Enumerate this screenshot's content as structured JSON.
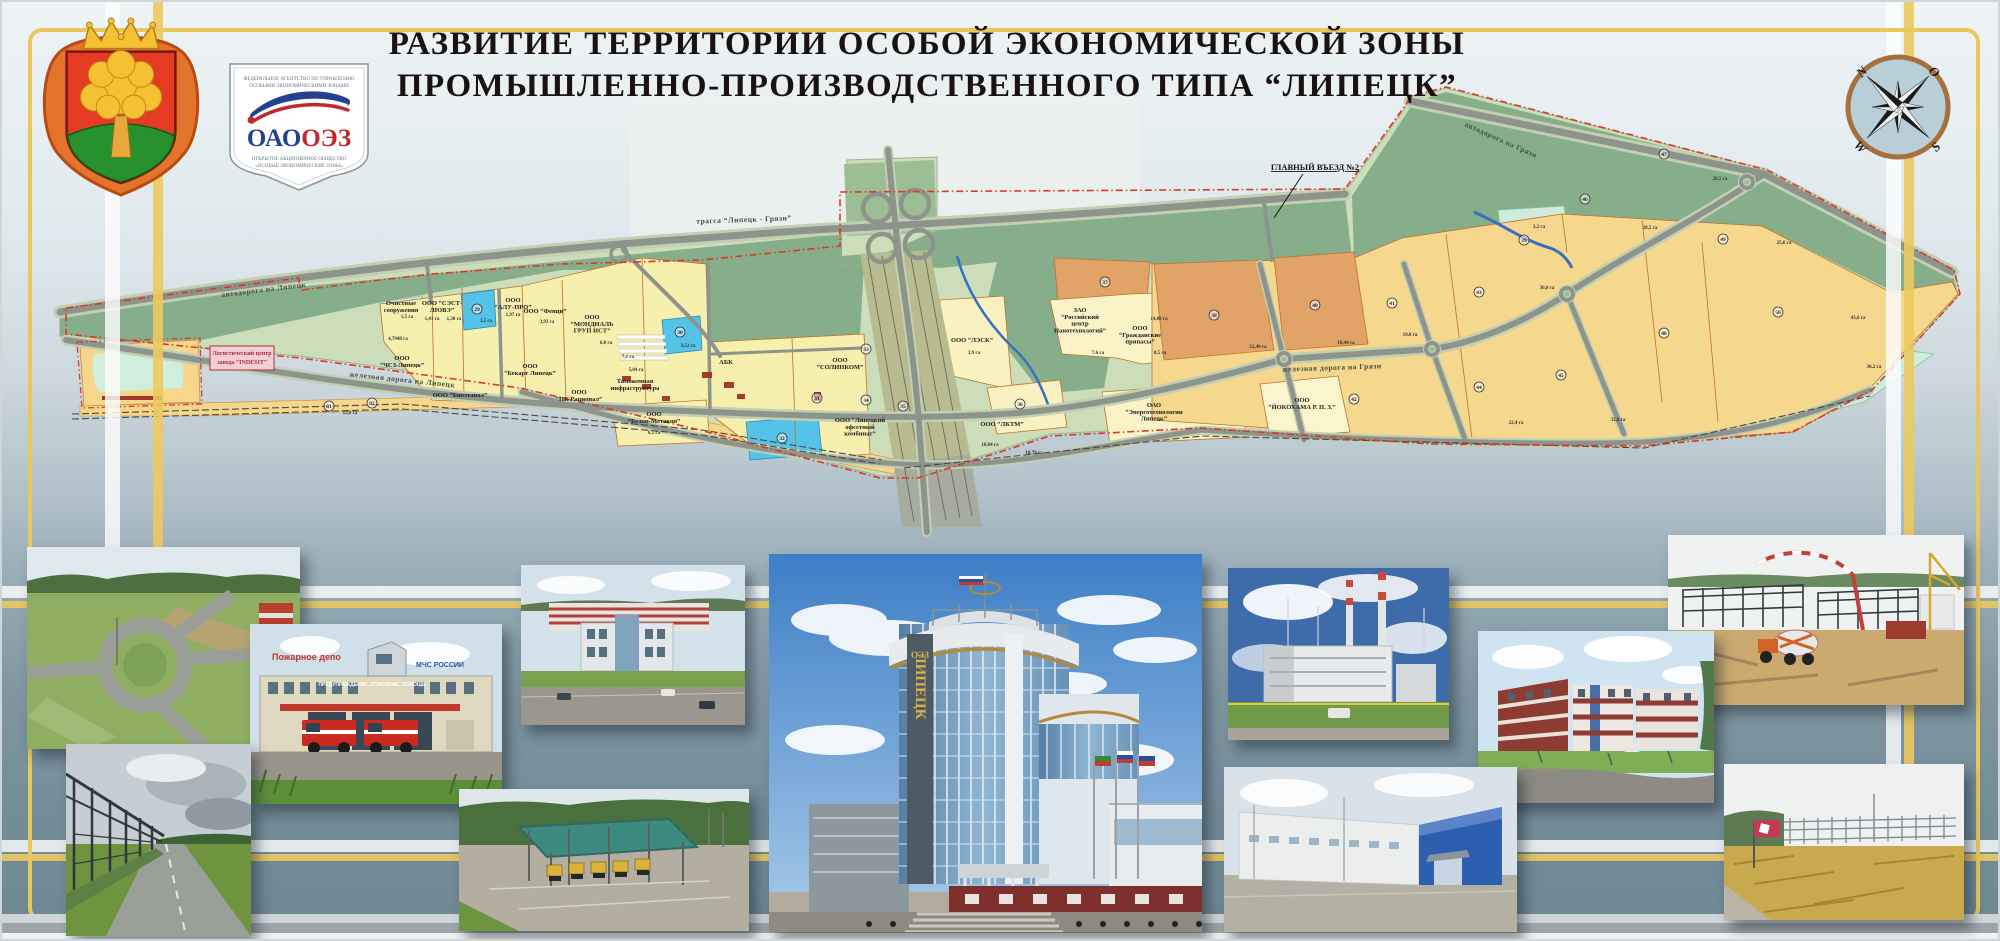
{
  "header": {
    "title_line1": "РАЗВИТИЕ ТЕРРИТОРИИ ОСОБОЙ ЭКОНОМИЧЕСКОЙ ЗОНЫ",
    "title_line2": "ПРОМЫШЛЕННО-ПРОИЗВОДСТВЕННОГО ТИПА “ЛИПЕЦК”"
  },
  "logo": {
    "agency_line1": "ФЕДЕРАЛЬНОЕ АГЕНТСТВО ПО УПРАВЛЕНИЮ",
    "agency_line2": "ОСОБЫМИ ЭКОНОМИЧЕСКИМИ ЗОНАМИ",
    "brand_blue": "ОАО",
    "brand_red": "ОЭЗ",
    "sub_line1": "ОТКРЫТОЕ АКЦИОНЕРНОЕ ОБЩЕСТВО",
    "sub_line2": "«ОСОБЫЕ ЭКОНОМИЧЕСКИЕ ЗОНЫ»"
  },
  "compass": {
    "n": "N",
    "e": "O",
    "s": "S",
    "w": "W"
  },
  "map": {
    "road_labels": [
      {
        "text": "автодорога на Липецк",
        "x": 262,
        "y": 290,
        "rot": -7
      },
      {
        "text": "трасса “Липецк - Грязи”",
        "x": 742,
        "y": 220,
        "rot": -2
      },
      {
        "text": "автодорога на Грязи",
        "x": 1498,
        "y": 140,
        "rot": 24
      },
      {
        "text": "железная дорога на Липецк",
        "x": 400,
        "y": 380,
        "rot": 6
      },
      {
        "text": "железная дорога на Грязи",
        "x": 1330,
        "y": 368,
        "rot": -2
      }
    ],
    "callouts": {
      "entrance": {
        "text": "ГЛАВНЫЙ ВЪЕЗД №2",
        "x": 1313,
        "y": 166
      },
      "indesit_line1": "Логистический центр",
      "indesit_line2": "завода “INDESIT”"
    },
    "company_labels": [
      {
        "text": "Очистные|сооружения",
        "x": 399,
        "y": 303
      },
      {
        "text": "ООО “СЭСТ-|ЛЮВЭ”",
        "x": 440,
        "y": 303
      },
      {
        "text": "ООО|“АЛУ-ПРО”",
        "x": 511,
        "y": 300
      },
      {
        "text": "ООО “Фенци”",
        "x": 543,
        "y": 311
      },
      {
        "text": "ООО|“МОНДИАЛЬ|ГРУП ИСТ”",
        "x": 590,
        "y": 317
      },
      {
        "text": "ООО|“ЧСЗ-Липецк”",
        "x": 400,
        "y": 358
      },
      {
        "text": "ООО|“Бекарт Липецк”",
        "x": 528,
        "y": 366
      },
      {
        "text": "ООО “Биоэтанол”",
        "x": 458,
        "y": 395
      },
      {
        "text": "ООО|“ПК Рационал”",
        "x": 577,
        "y": 392
      },
      {
        "text": "Таможенная|инфраструктура",
        "x": 633,
        "y": 381
      },
      {
        "text": "АБК",
        "x": 724,
        "y": 362
      },
      {
        "text": "ООО|“Белон-Метакон”",
        "x": 652,
        "y": 414
      },
      {
        "text": "ООО|“СОЛИНКОМ”",
        "x": 838,
        "y": 360
      },
      {
        "text": "ООО “Липецкий|офсетный|комбинат”",
        "x": 858,
        "y": 420
      },
      {
        "text": "ООО “ЛЭСК”",
        "x": 970,
        "y": 340
      },
      {
        "text": "ООО “ЛКТМ”",
        "x": 1000,
        "y": 424
      },
      {
        "text": "ЗАО|“Российский|центр|Нанотехнологий”",
        "x": 1078,
        "y": 310
      },
      {
        "text": "ООО|“Гражданские|припасы”",
        "x": 1138,
        "y": 328
      },
      {
        "text": "ОАО|“Энерготехнологии|Липецк”",
        "x": 1152,
        "y": 405
      },
      {
        "text": "ООО|“ЙОКОХАМА Р. П. З.”",
        "x": 1300,
        "y": 400
      }
    ],
    "area_labels": [
      {
        "text": "1,5 га",
        "x": 405,
        "y": 316
      },
      {
        "text": "1,41 га",
        "x": 430,
        "y": 318
      },
      {
        "text": "1,30 га",
        "x": 452,
        "y": 318
      },
      {
        "text": "3,5 га",
        "x": 484,
        "y": 320
      },
      {
        "text": "1,97 га",
        "x": 511,
        "y": 314
      },
      {
        "text": "3,93 га",
        "x": 545,
        "y": 321
      },
      {
        "text": "6,8 га",
        "x": 604,
        "y": 342
      },
      {
        "text": "3,52 га",
        "x": 686,
        "y": 345
      },
      {
        "text": "4,7948 га",
        "x": 396,
        "y": 338
      },
      {
        "text": "7,1 га",
        "x": 626,
        "y": 356
      },
      {
        "text": "5,04 га",
        "x": 634,
        "y": 369
      },
      {
        "text": "6,5 га",
        "x": 652,
        "y": 432
      },
      {
        "text": "3,9 га",
        "x": 972,
        "y": 352
      },
      {
        "text": "10,04 га",
        "x": 988,
        "y": 444
      },
      {
        "text": "10,79 га",
        "x": 1032,
        "y": 452
      },
      {
        "text": "7,6 га",
        "x": 1096,
        "y": 352
      },
      {
        "text": "8,5 га",
        "x": 1158,
        "y": 352
      },
      {
        "text": "14,88 га",
        "x": 1157,
        "y": 318
      },
      {
        "text": "22,48 га",
        "x": 1256,
        "y": 346
      },
      {
        "text": "18,44 га",
        "x": 1344,
        "y": 342
      },
      {
        "text": "19,0 га",
        "x": 1408,
        "y": 334
      },
      {
        "text": "3,2 га",
        "x": 1537,
        "y": 226
      },
      {
        "text": "36,0 га",
        "x": 1545,
        "y": 287
      },
      {
        "text": "22,4 га",
        "x": 1514,
        "y": 422
      },
      {
        "text": "32,6 га",
        "x": 1616,
        "y": 419
      },
      {
        "text": "28,5 га",
        "x": 1648,
        "y": 227
      },
      {
        "text": "26,5 га",
        "x": 1718,
        "y": 178
      },
      {
        "text": "25,6 га",
        "x": 1782,
        "y": 242
      },
      {
        "text": "43,6 га",
        "x": 1856,
        "y": 317
      },
      {
        "text": "36,2 га",
        "x": 1872,
        "y": 366
      },
      {
        "text": "12,6 га",
        "x": 348,
        "y": 412
      }
    ],
    "parcel_numbers": [
      {
        "n": "29",
        "x": 475,
        "y": 307
      },
      {
        "n": "30",
        "x": 678,
        "y": 330
      },
      {
        "n": "81",
        "x": 327,
        "y": 404
      },
      {
        "n": "82",
        "x": 370,
        "y": 401
      },
      {
        "n": "31",
        "x": 815,
        "y": 396
      },
      {
        "n": "32",
        "x": 780,
        "y": 436
      },
      {
        "n": "33",
        "x": 864,
        "y": 347
      },
      {
        "n": "34",
        "x": 864,
        "y": 398
      },
      {
        "n": "35",
        "x": 901,
        "y": 404
      },
      {
        "n": "36",
        "x": 1018,
        "y": 402
      },
      {
        "n": "37",
        "x": 1103,
        "y": 280
      },
      {
        "n": "38",
        "x": 1212,
        "y": 313
      },
      {
        "n": "39",
        "x": 1522,
        "y": 238
      },
      {
        "n": "40",
        "x": 1313,
        "y": 303
      },
      {
        "n": "41",
        "x": 1390,
        "y": 301
      },
      {
        "n": "42",
        "x": 1352,
        "y": 397
      },
      {
        "n": "43",
        "x": 1477,
        "y": 290
      },
      {
        "n": "44",
        "x": 1477,
        "y": 385
      },
      {
        "n": "45",
        "x": 1559,
        "y": 373
      },
      {
        "n": "46",
        "x": 1583,
        "y": 197
      },
      {
        "n": "47",
        "x": 1662,
        "y": 152
      },
      {
        "n": "48",
        "x": 1662,
        "y": 331
      },
      {
        "n": "49",
        "x": 1721,
        "y": 237
      },
      {
        "n": "50",
        "x": 1776,
        "y": 310
      }
    ]
  },
  "photo_texts": {
    "fire_sign": "Пожарное депо",
    "fire_mchs": "МЧС РОССИИ",
    "fire_banner": "ПРЕДУПРЕЖДЕНИЕ, СПАСЕНИЕ, ПОМОЩЬ"
  },
  "building_sign": {
    "oez": "ОЭЗ",
    "vertical": "ЛИПЕЦК"
  },
  "photos": [
    {
      "id": "roundabout-aerial"
    },
    {
      "id": "pipe-rack-road"
    },
    {
      "id": "fire-station"
    },
    {
      "id": "office-building"
    },
    {
      "id": "weighbridge"
    },
    {
      "id": "oez-admin-building"
    },
    {
      "id": "power-plant"
    },
    {
      "id": "residential-blocks"
    },
    {
      "id": "blue-warehouse"
    },
    {
      "id": "construction-site"
    },
    {
      "id": "field-framework"
    }
  ],
  "colors": {
    "accent_yellow": "#e9c75c",
    "title": "#191210",
    "boundary_red": "#d93a28",
    "parcel_yellow": "#f7efae",
    "parcel_warm": "#f5d78d",
    "parcel_orange": "#e2a368",
    "parcel_cyan": "#55c3e8",
    "parcel_mint": "#cdecdb",
    "green_dark": "#86ae8b",
    "green_light": "#cfdfbe",
    "logo_blue": "#24418f",
    "logo_red": "#c3272e"
  }
}
